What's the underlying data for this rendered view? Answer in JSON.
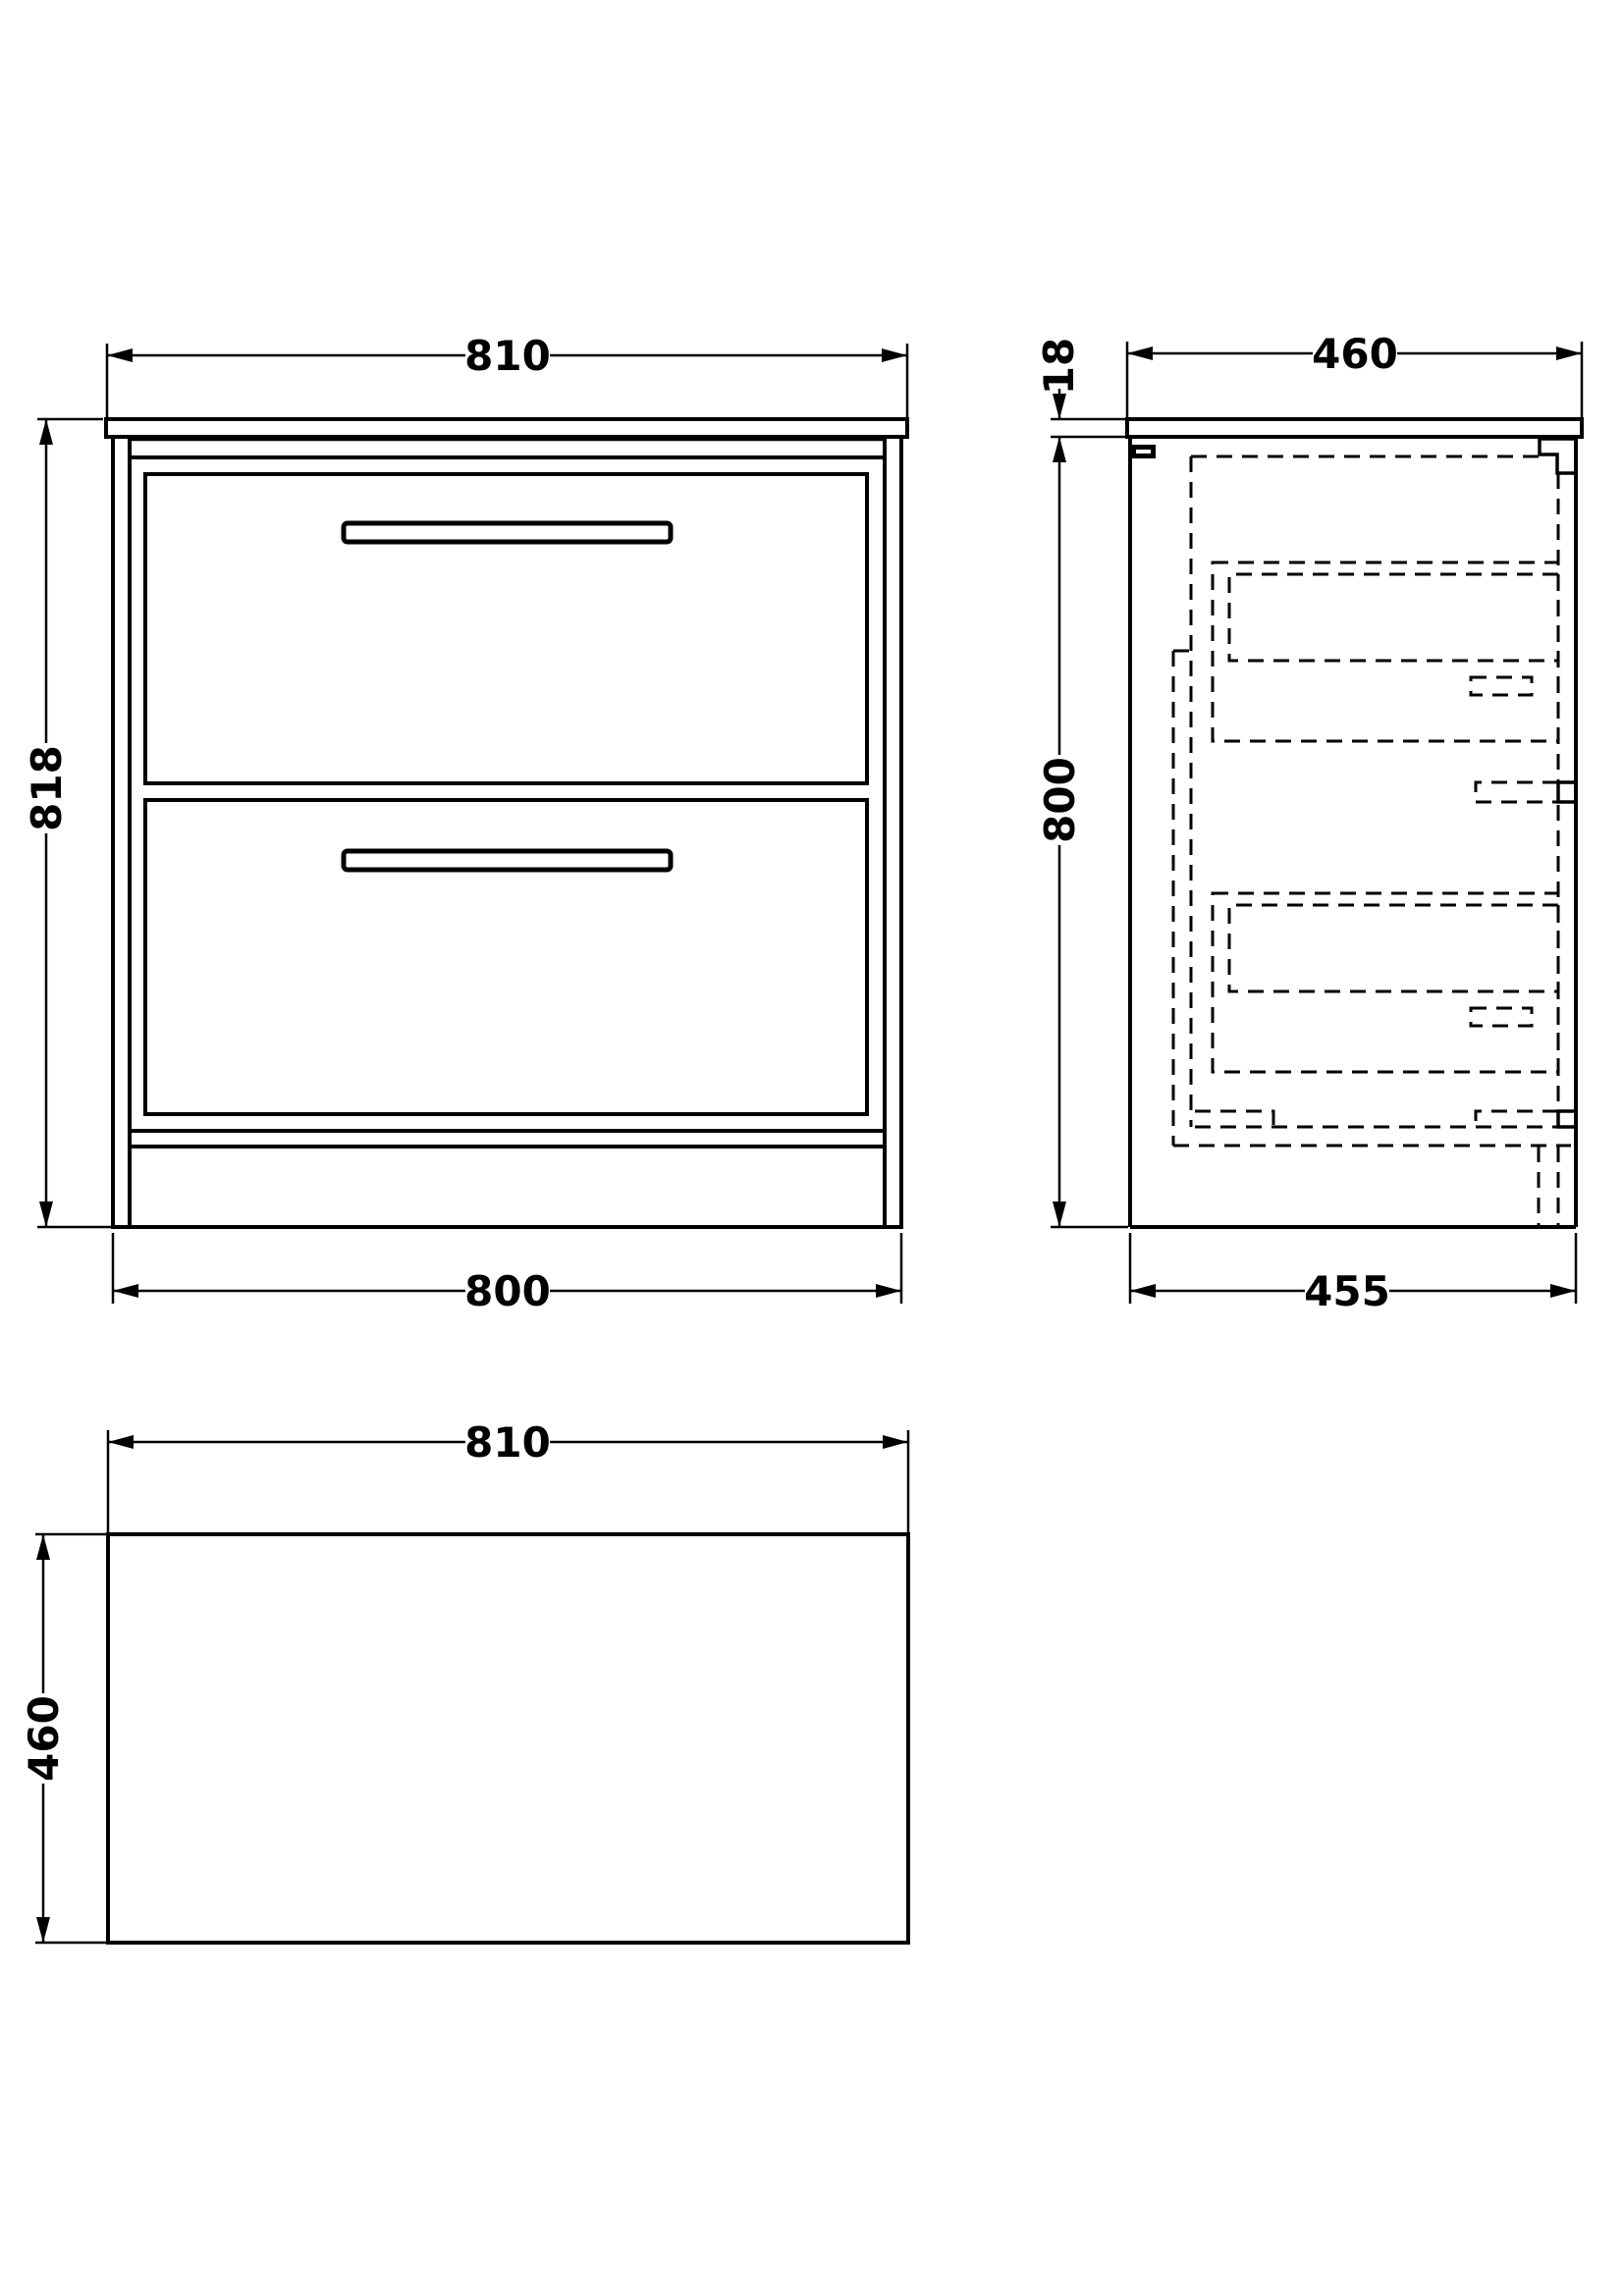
{
  "drawing": {
    "type": "technical-dimension-drawing",
    "subject": "two-drawer floor-standing vanity unit with countertop",
    "colors": {
      "line": "#000000",
      "background": "#ffffff"
    },
    "views": {
      "front_elevation": {
        "name": "front elevation",
        "dimensions": {
          "counter_width": "810",
          "overall_height": "818",
          "cabinet_width": "800"
        }
      },
      "side_section": {
        "name": "side section",
        "dimensions": {
          "counter_depth": "460",
          "counter_thickness": "18",
          "cabinet_height": "800",
          "cabinet_depth": "455"
        }
      },
      "plan_view": {
        "name": "plan view",
        "dimensions": {
          "counter_width": "810",
          "counter_depth": "460"
        }
      }
    }
  }
}
